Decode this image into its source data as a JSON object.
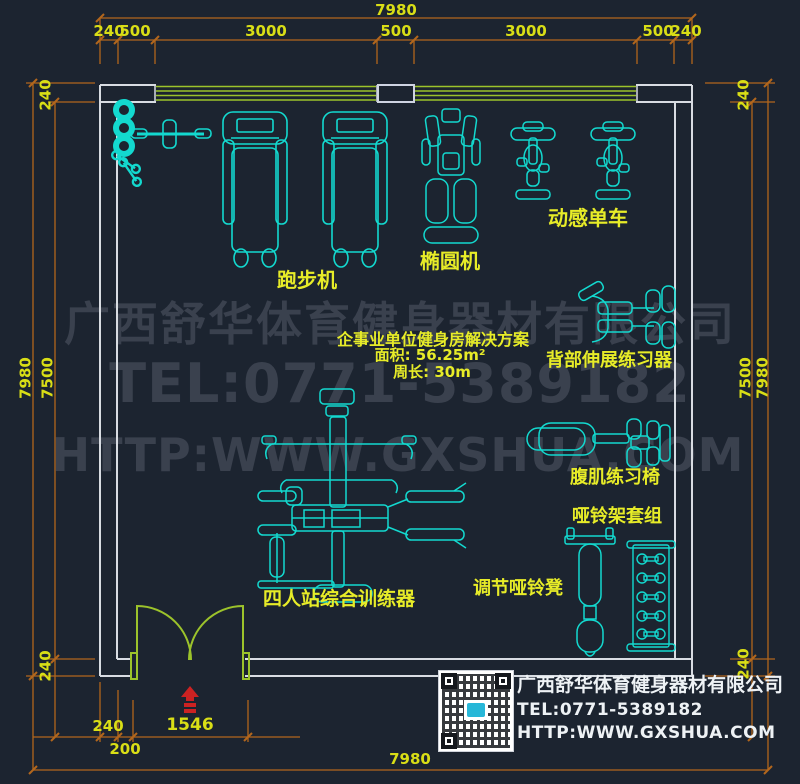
{
  "drawing": {
    "background_color": "#1c2430",
    "equipment_color": "#13d9cf",
    "label_color": "#e7ec28",
    "dimension_line_color": "#b2661c",
    "dimension_text_color": "#d9de16",
    "wall_color": "#d8dce2",
    "window_door_color": "#9cc32b",
    "entrance_marker_color": "#cc2222",
    "watermark_color": "#3a414e"
  },
  "dimensions": {
    "top": {
      "total": "7980",
      "segments": [
        "240",
        "500",
        "3000",
        "500",
        "3000",
        "500",
        "240"
      ]
    },
    "left": {
      "overall": "7980",
      "inner": "7500",
      "wall_top": "240",
      "wall_bottom": "240"
    },
    "right": {
      "inner": "7500",
      "overall": "7980",
      "wall_top": "240",
      "wall_bottom": "240"
    },
    "bottom": {
      "wall": "240",
      "offset": "200",
      "door": "1546",
      "total": "7980"
    }
  },
  "equipment_labels": {
    "treadmill": "跑步机",
    "elliptical": "椭圆机",
    "spin_bike": "动感单车",
    "back_extension": "背部伸展练习器",
    "ab_chair": "腹肌练习椅",
    "dumbbell_rack_set": "哑铃架套组",
    "adjustable_dumbbell_bench": "调节哑铃凳",
    "four_person_multi_station": "四人站综合训练器"
  },
  "plan_info": {
    "title": "企事业单位健身房解决方案",
    "area": "面积: 56.25m²",
    "perimeter": "周长: 30m"
  },
  "watermark": {
    "company": "广西舒华体育健身器材有限公司",
    "tel": "TEL:0771-5389182",
    "web": "HTTP:WWW.GXSHUA.COM"
  },
  "footer": {
    "company": "广西舒华体育健身器材有限公司",
    "tel": "TEL:0771-5389182",
    "web": "HTTP:WWW.GXSHUA.COM"
  }
}
